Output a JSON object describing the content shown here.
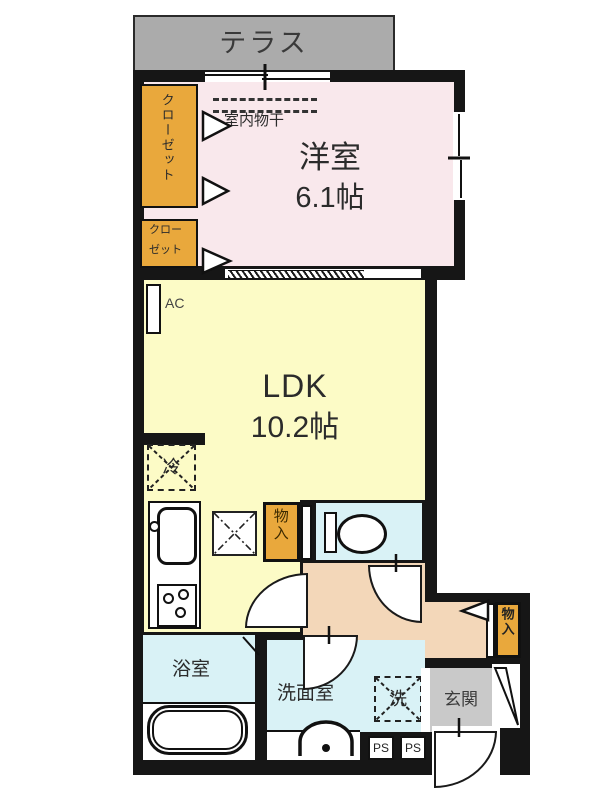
{
  "title": "floor-plan",
  "colors": {
    "wall": "#161616",
    "terrace_bg": "#ababab",
    "entrance_bg": "#c9c9c9",
    "western_bg": "#f9e8ec",
    "ldk_bg": "#fcfbc6",
    "wet_bg": "#d9f2f6",
    "hall_bg": "#f3d7b9",
    "closet_bg": "#e9a83c"
  },
  "rooms": {
    "terrace": {
      "label": "テラス"
    },
    "western": {
      "name": "洋室",
      "size": "6.1帖"
    },
    "ldk": {
      "name": "LDK",
      "size": "10.2帖"
    },
    "bathroom": {
      "label": "浴室"
    },
    "washroom": {
      "label": "洗面室"
    },
    "entrance": {
      "label": "玄関"
    }
  },
  "closets": {
    "large": "クローゼット",
    "small_line1": "クロー",
    "small_line2": "ゼット"
  },
  "storage": {
    "kitchen": "物入",
    "entrance": "物入"
  },
  "symbols": {
    "ac": "AC",
    "indoor_drying": "室内物干",
    "refrigerator": "冷",
    "washer": "洗",
    "ps1": "PS",
    "ps2": "PS"
  }
}
